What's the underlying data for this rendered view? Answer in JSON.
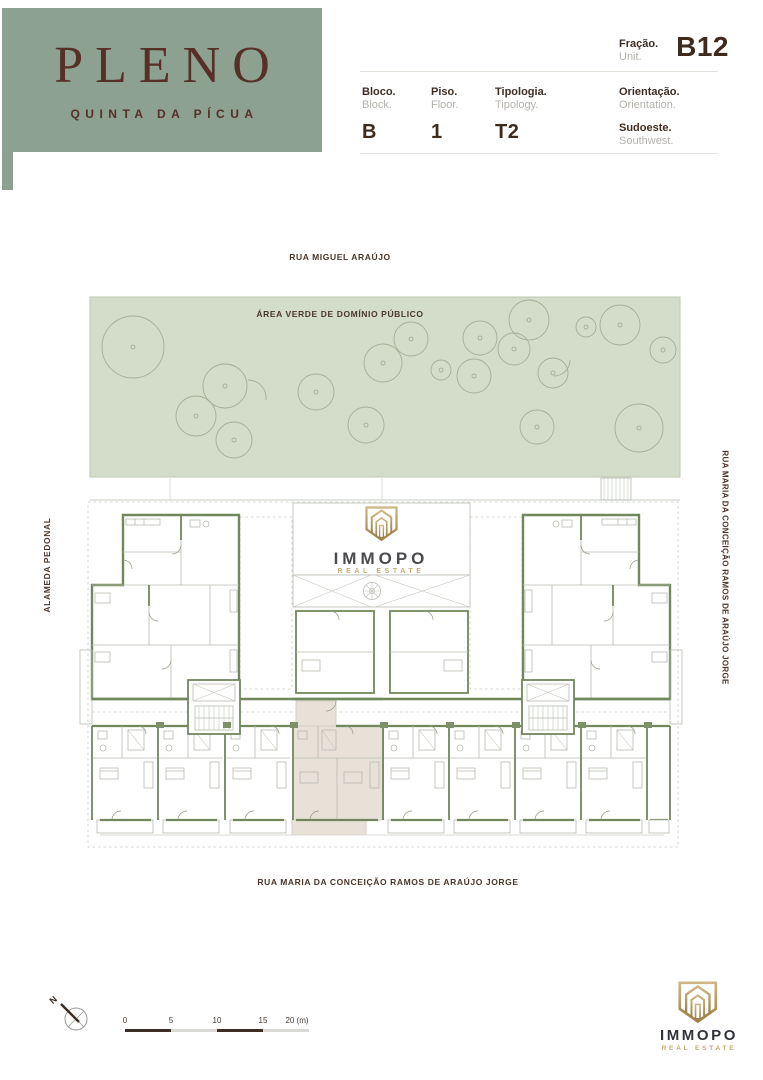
{
  "brand": {
    "name": "PLENO",
    "subtitle": "QUINTA DA PÍCUA"
  },
  "unit_info": {
    "fraction": {
      "label": "Fração.",
      "label_en": "Unit.",
      "value": "B12"
    },
    "fields": [
      {
        "label": "Bloco.",
        "label_en": "Block.",
        "value": "B"
      },
      {
        "label": "Piso.",
        "label_en": "Floor.",
        "value": "1"
      },
      {
        "label": "Tipologia.",
        "label_en": "Tipology.",
        "value": "T2"
      },
      {
        "label": "Orientação.",
        "label_en": "Orientation.",
        "value": "Sudoeste.",
        "value_en": "Southwest."
      }
    ]
  },
  "map": {
    "street_top": "RUA MIGUEL ARAÚJO",
    "green_area_label": "ÁREA VERDE DE DOMÍNIO PÚBLICO",
    "street_left": "ALAMEDA PEDONAL",
    "street_right": "RUA MARIA DA CONCEIÇÃO RAMOS DE ARAÚJO JORGE",
    "street_bottom": "RUA MARIA DA CONCEIÇÃO RAMOS DE ARAÚJO JORGE"
  },
  "watermark": {
    "name": "IMMOPO",
    "tagline": "REAL ESTATE"
  },
  "footer_logo": {
    "name": "IMMOPO",
    "tagline": "REAL ESTATE"
  },
  "scale_bar": {
    "labels": [
      "0",
      "5",
      "10",
      "15",
      "20 (m)"
    ]
  },
  "compass": {
    "north_label": "N"
  },
  "colors": {
    "brand_green": "#8CA18F",
    "brand_maroon": "#572F26",
    "text_dark": "#3F2D22",
    "text_gray": "#B5B2AD",
    "plan_wall_green": "#73875E",
    "green_area_fill": "#D4DCCA",
    "highlight_beige": "#E7E1D8",
    "logo_gold": "#C8AB74"
  }
}
